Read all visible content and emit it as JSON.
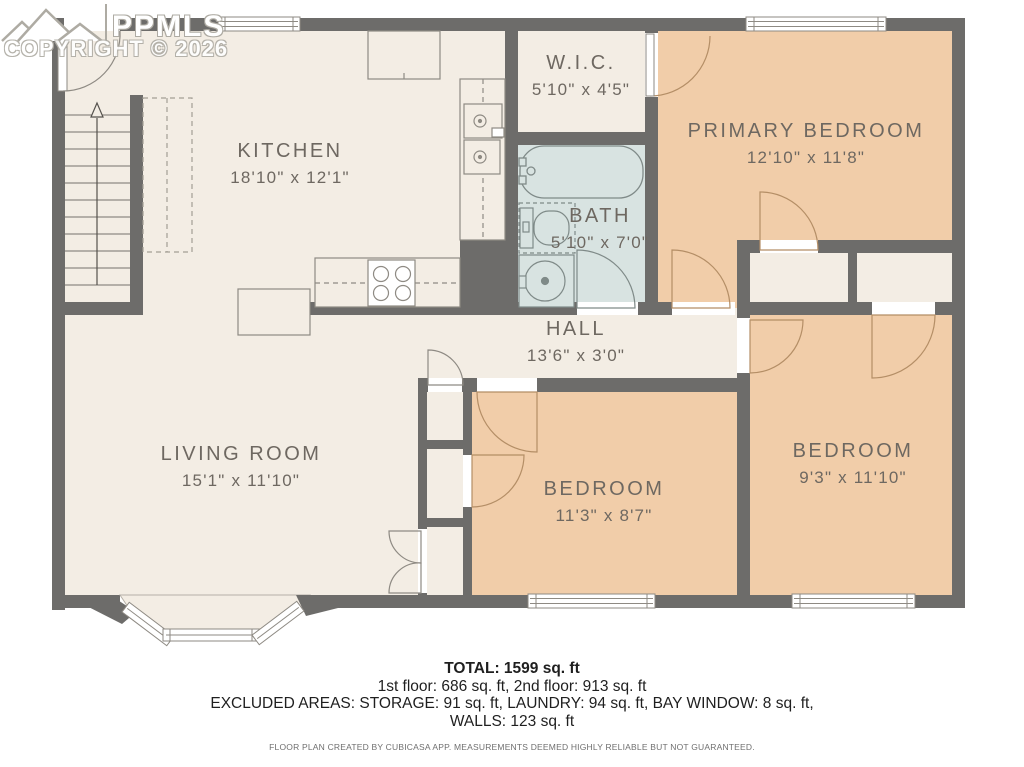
{
  "watermark": {
    "logo_text": "PPMLS",
    "copyright": "COPYRIGHT © 2026"
  },
  "rooms": [
    {
      "name": "KITCHEN",
      "dims": "18'10\" x 12'1\""
    },
    {
      "name": "W.I.C.",
      "dims": "5'10\" x 4'5\""
    },
    {
      "name": "BATH",
      "dims": "5'10\" x 7'0\""
    },
    {
      "name": "PRIMARY BEDROOM",
      "dims": "12'10\" x 11'8\""
    },
    {
      "name": "HALL",
      "dims": "13'6\" x 3'0\""
    },
    {
      "name": "LIVING ROOM",
      "dims": "15'1\" x 11'10\""
    },
    {
      "name": "BEDROOM",
      "dims": "11'3\" x 8'7\""
    },
    {
      "name": "BEDROOM",
      "dims": "9'3\" x 11'10\""
    }
  ],
  "summary": {
    "total": "TOTAL: 1599 sq. ft",
    "floors": "1st floor: 686 sq. ft, 2nd floor: 913 sq. ft",
    "excluded": "EXCLUDED AREAS: STORAGE: 91 sq. ft, LAUNDRY: 94 sq. ft, BAY WINDOW: 8 sq. ft,",
    "walls": "WALLS: 123 sq. ft",
    "disclaimer": "FLOOR PLAN CREATED BY CUBICASA APP. MEASUREMENTS DEEMED HIGHLY RELIABLE BUT NOT GUARANTEED."
  },
  "colors": {
    "wall": "#6d6c6a",
    "floor_cream": "#f3ede4",
    "bedroom_peach": "#f1cda9",
    "bath_blue": "#d8e3e1",
    "label_text": "#6e6861"
  }
}
